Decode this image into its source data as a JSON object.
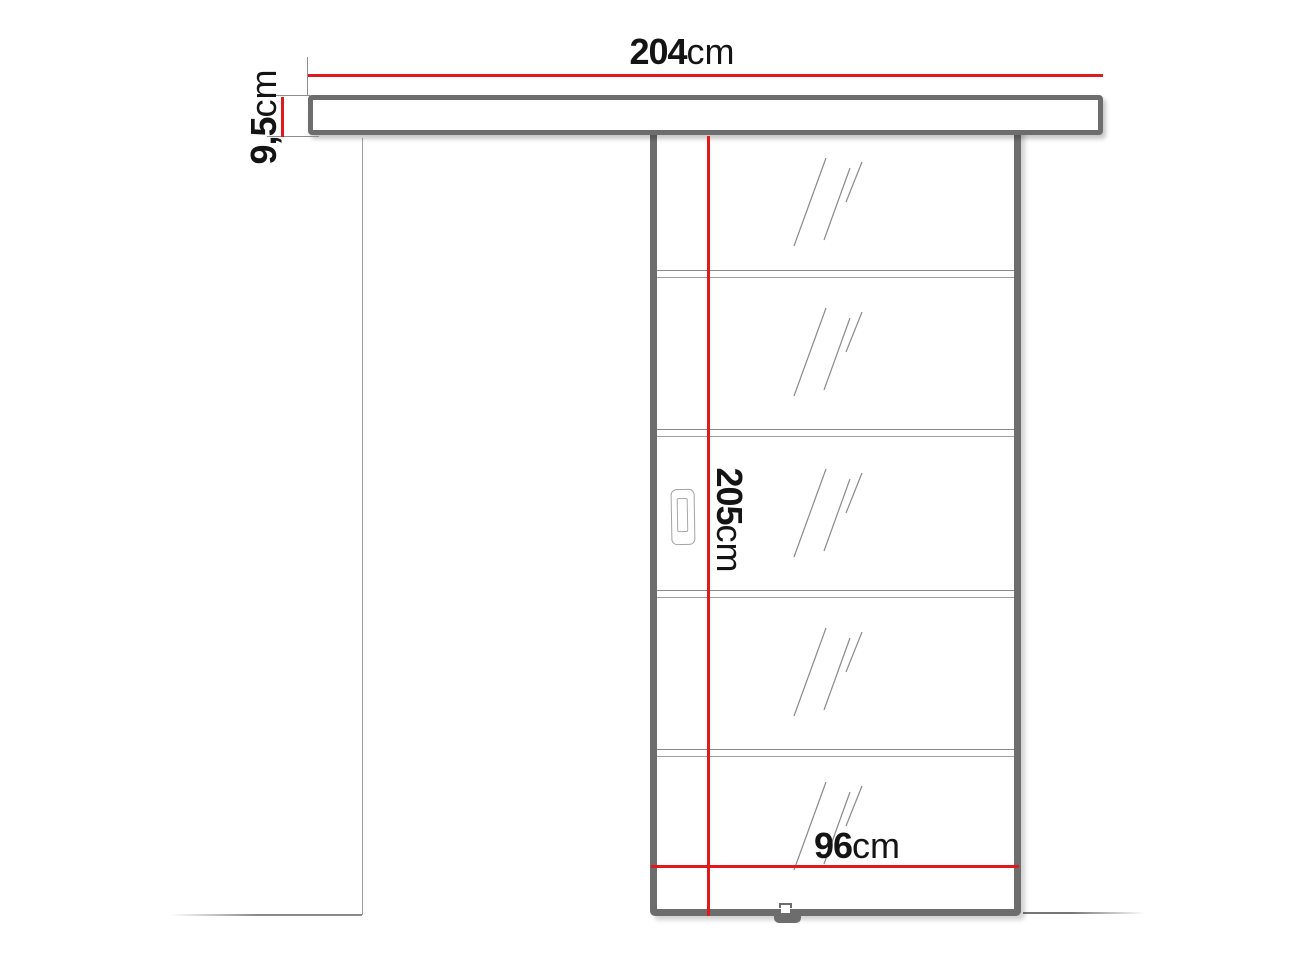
{
  "diagram_type": "sliding-door-technical-drawing",
  "labels": {
    "rail_width": {
      "value": "204",
      "unit": "cm"
    },
    "rail_height": {
      "value": "9,5",
      "unit": "cm"
    },
    "door_height": {
      "value": "205",
      "unit": "cm"
    },
    "door_width": {
      "value": "96",
      "unit": "cm"
    }
  },
  "door": {
    "glass_panels": 5,
    "glass_dividers": 4,
    "has_handle": true,
    "has_floor_guide": true
  },
  "colors": {
    "dimension_line": "#e01a1c",
    "frame": "#6d6d6d",
    "thin_line": "#8d8d8d",
    "text": "#141414",
    "background": "#ffffff"
  }
}
